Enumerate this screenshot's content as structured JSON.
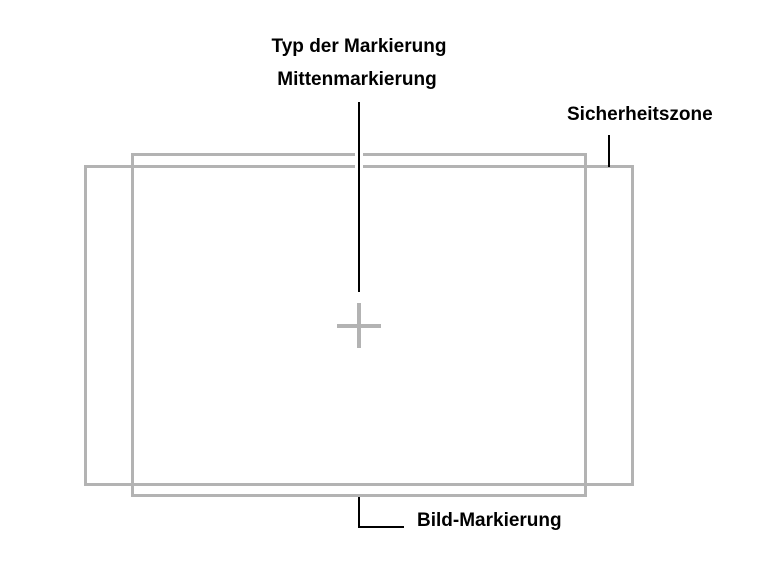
{
  "diagram": {
    "heading": "Typ der Markierung",
    "labels": {
      "center_marker": "Mittenmarkierung",
      "safe_zone": "Sicherheitszone",
      "image_marker": "Bild-Markierung"
    },
    "colors": {
      "marker_gray": "#b3b3b3",
      "leader_line": "#000000",
      "background": "#ffffff",
      "text": "#000000"
    }
  }
}
